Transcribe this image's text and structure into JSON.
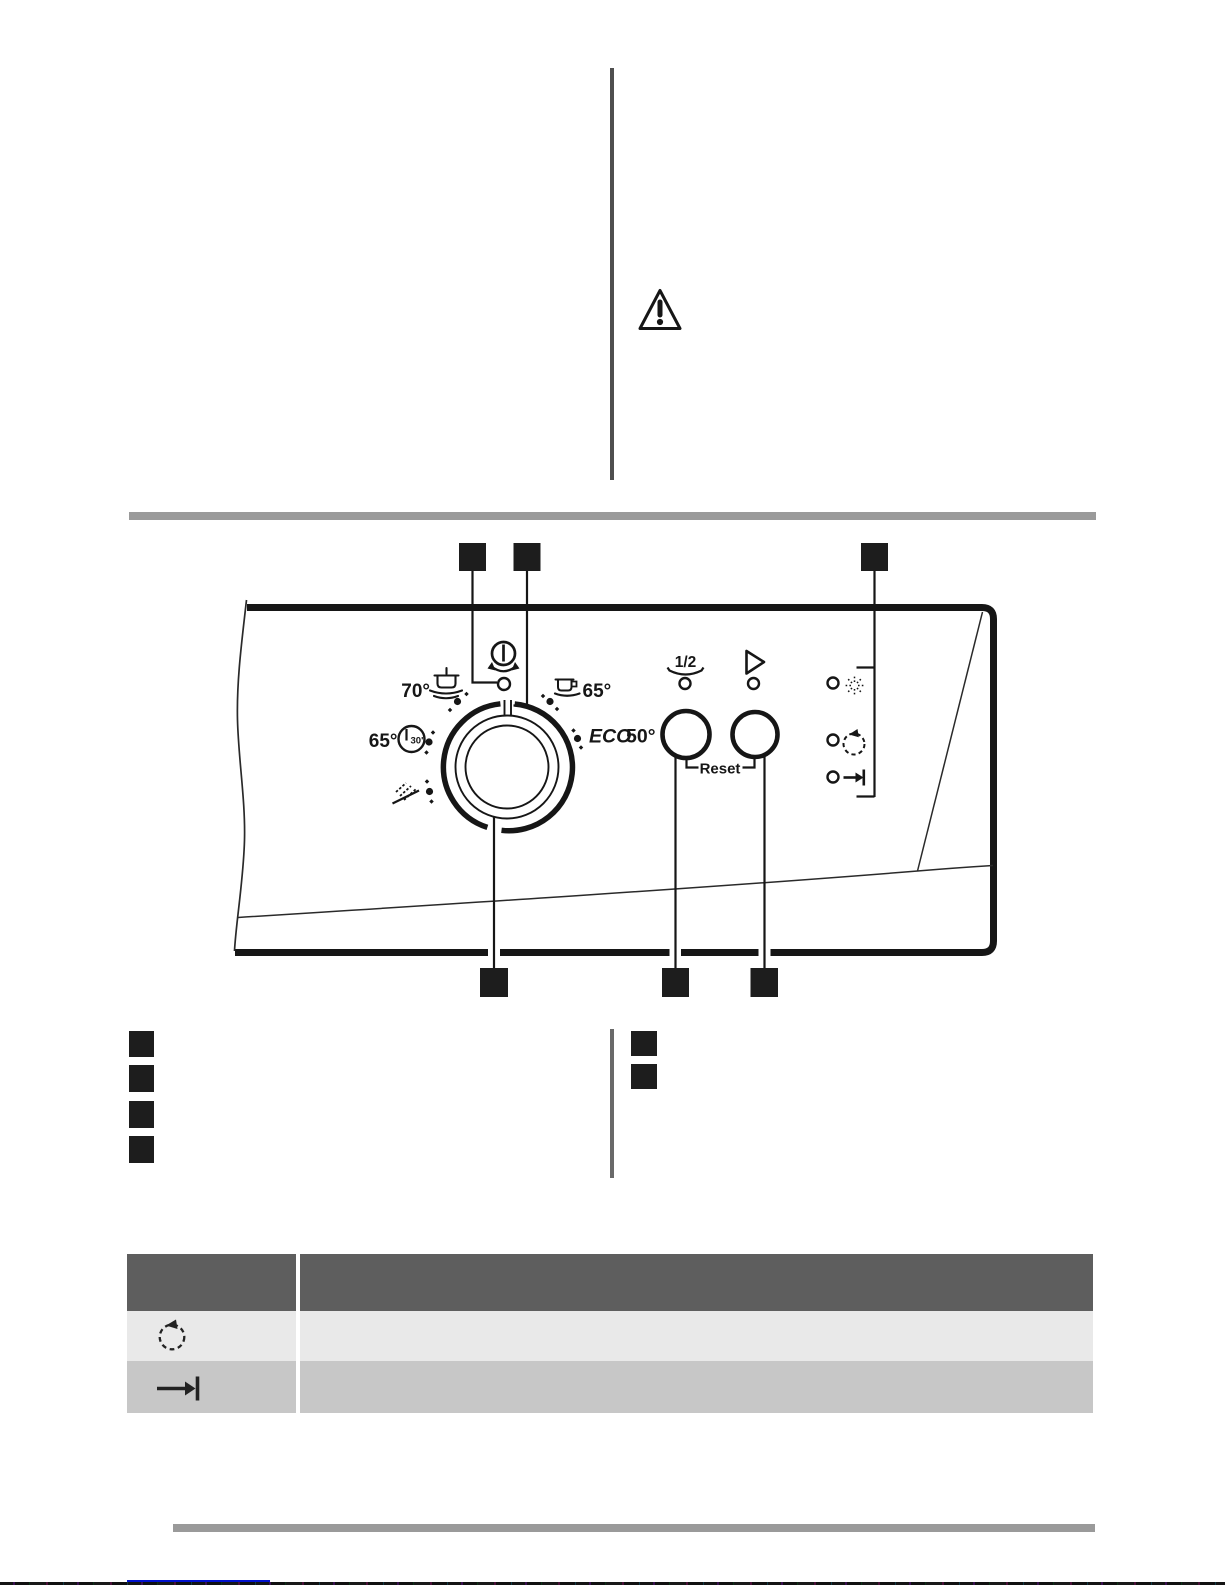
{
  "warning": {
    "icon": "warning-triangle-icon"
  },
  "panel": {
    "power": {
      "icon": "power-icon",
      "rotate_icon": "rotate-arrows-icon"
    },
    "dial_icon": "program-dial",
    "programs": {
      "intensive_temp": "70°",
      "intensive_icon": "pot-icon",
      "quick_temp": "65°",
      "quick_time": "30'",
      "quick_icon": "clock-icon",
      "rinse_icon": "spray-icon",
      "normal_temp": "65°",
      "normal_icon": "cup-icon",
      "eco_name": "ECO",
      "eco_temp": "50°"
    },
    "half_load_label": "1/2",
    "reset_label": "Reset",
    "indicator_icons": [
      "salt-icon",
      "rinse-aid-icon",
      "end-of-programme-icon"
    ]
  },
  "legend": {
    "left_markers": 4,
    "right_markers": 2
  },
  "table": {
    "header": {
      "col_icon": "",
      "col_text": ""
    },
    "rows": [
      {
        "icon": "rinse-aid-indicator-icon",
        "text": ""
      },
      {
        "icon": "end-of-programme-indicator-icon",
        "text": ""
      }
    ]
  },
  "colors": {
    "section_bar": "#9a9a9a",
    "table_header_bg": "#5e5e5e",
    "table_row1_bg": "#e9e9e9",
    "table_row2_bg": "#c7c7c7",
    "marker": "#1d1d1d",
    "column_divider": "#4f4f4f",
    "list_divider": "#696969",
    "footer_link_line": "#0011cc",
    "ink": "#161616"
  }
}
